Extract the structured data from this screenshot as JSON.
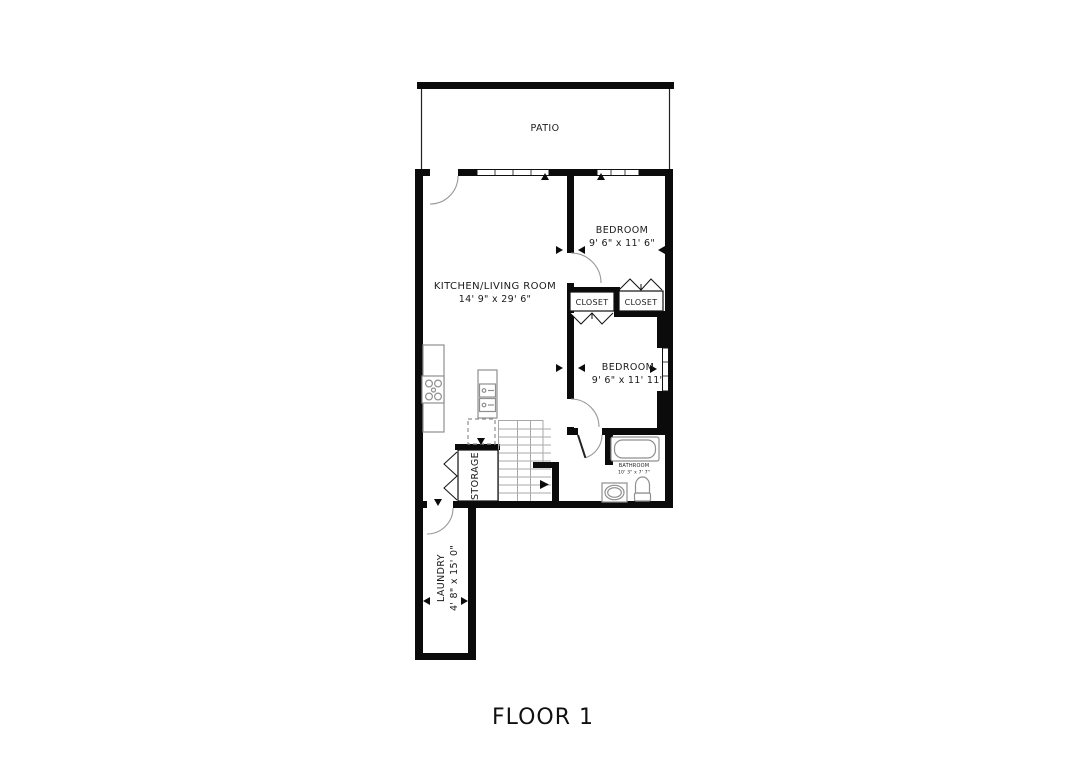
{
  "plan": {
    "floor_label": "FLOOR 1"
  },
  "rooms": {
    "patio": {
      "name": "PATIO"
    },
    "kitchen_living": {
      "name": "KITCHEN/LIVING ROOM",
      "dims": "14' 9\" x 29' 6\""
    },
    "bedroom1": {
      "name": "BEDROOM",
      "dims": "9' 6\" x 11' 6\""
    },
    "closet_left": {
      "name": "CLOSET"
    },
    "closet_right": {
      "name": "CLOSET"
    },
    "bedroom2": {
      "name": "BEDROOM",
      "dims": "9' 6\" x 11' 11\""
    },
    "bathroom": {
      "name": "BATHROOM",
      "dims": "10' 3\" x 7' 7\""
    },
    "storage": {
      "name": "STORAGE"
    },
    "laundry": {
      "name": "LAUNDRY",
      "dims": "4' 8\" x 15' 0\""
    }
  },
  "colors": {
    "wall": "#0b0b0b",
    "fixture": "#8f8f8f",
    "background": "#ffffff",
    "text": "#1a1a1a"
  }
}
